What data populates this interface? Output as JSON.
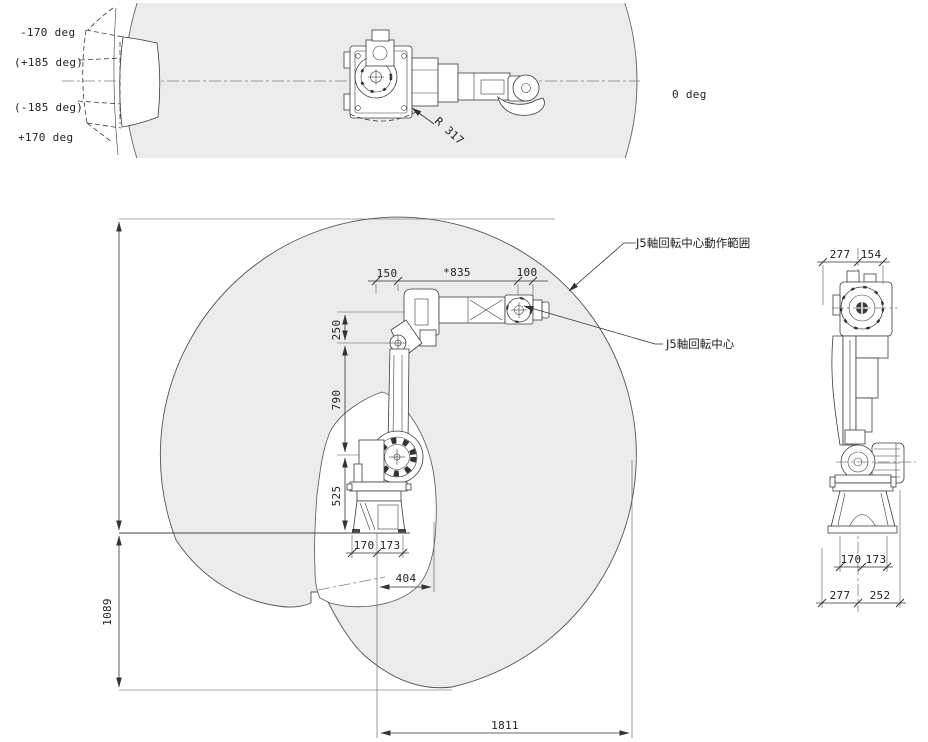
{
  "top_view": {
    "angle_labels": [
      "-170 deg",
      "(+185 deg)",
      "(-185 deg)",
      "+170 deg"
    ],
    "zero_label": "0 deg",
    "radius_label": "R 317"
  },
  "side_view": {
    "dim_150": "150",
    "dim_835": "*835",
    "dim_100": "100",
    "dim_250": "250",
    "dim_790": "790",
    "dim_525": "525",
    "dim_170": "170",
    "dim_173": "173",
    "dim_404": "404",
    "dim_1089": "1089",
    "dim_1811": "1811",
    "leader_range": "J5軸回転中心動作範囲",
    "leader_center": "J5軸回転中心"
  },
  "rear_view": {
    "dim_top_277": "277",
    "dim_top_154": "154",
    "dim_base_170": "170",
    "dim_base_173": "173",
    "dim_bottom_277": "277",
    "dim_bottom_252": "252"
  },
  "colors": {
    "envelope_fill": "#ececec",
    "line": "#3c3c3c",
    "dim": "#333333",
    "centerline": "#808080"
  }
}
